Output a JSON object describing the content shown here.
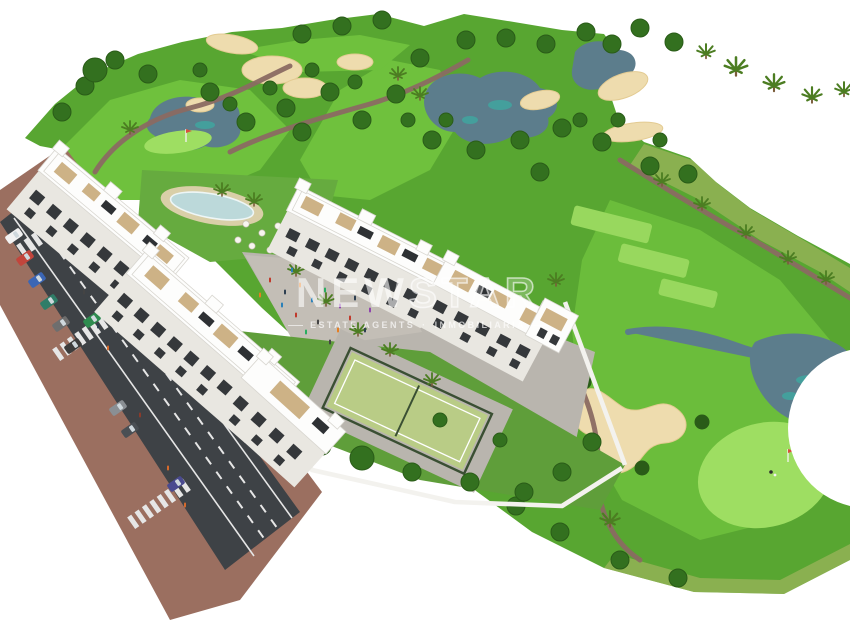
{
  "watermark": {
    "brand_solid": "NEW",
    "brand_outline": "STAR",
    "tagline_left": "ESTATE AGENTS",
    "tagline_separator": "·",
    "tagline_right": "INMOBILIARIA"
  },
  "scene": {
    "description": "Aerial 3D architectural render of a white apartment complex with pool, paddle court and gardens beside a golf course with fairways, bunkers, lakes, palm trees and an access road with cars",
    "elements": [
      "golf-course",
      "fairways",
      "tee-boxes",
      "putting-greens",
      "flag-pin",
      "golfer",
      "golf-cart",
      "sand-bunkers",
      "lakes",
      "stream",
      "cart-paths",
      "trees",
      "palm-trees",
      "apartment-blocks",
      "rooftop-terraces",
      "solar-panels",
      "swimming-pool",
      "pool-umbrellas",
      "lawn",
      "plaza",
      "pedestrians",
      "paddle-court",
      "gardens",
      "perimeter-walls",
      "access-road",
      "lane-markings",
      "crosswalks",
      "cars",
      "sidewalks"
    ]
  },
  "palette": {
    "course": "#58a631",
    "fairway": "#6fc13d",
    "scrub": "#b5b86a",
    "teegreen": "#98d85e",
    "puttinggreen": "#9ede62",
    "tree": "#33701f",
    "treedark": "#2a5c18",
    "palm": "#4c7d22",
    "trunk": "#7a5c3a",
    "sand": "#eedcae",
    "sandedge": "#e3cb92",
    "water": "#5c7d8c",
    "wateraccent": "#3fa8a0",
    "path": "#8a6a62",
    "road": "#3e4246",
    "roadline": "#e6e6e6",
    "sidewalk": "#9b6f60",
    "building": "#fdfdfc",
    "buildingshade": "#e9e7e1",
    "buildingedge": "#d8d6d0",
    "window": "#35383b",
    "terrace": "#cdb286",
    "solar": "#2e3134",
    "pool": "#bcd9da",
    "pooldeck": "#d9cfa8",
    "lawn": "#66ab3f",
    "garden": "#5f9e3a",
    "plaza": "#c3beb6",
    "paving": "#b9b5ae",
    "court": "#b9cc86",
    "courtfence": "#3a4f33",
    "wall": "#f3f2ee"
  }
}
